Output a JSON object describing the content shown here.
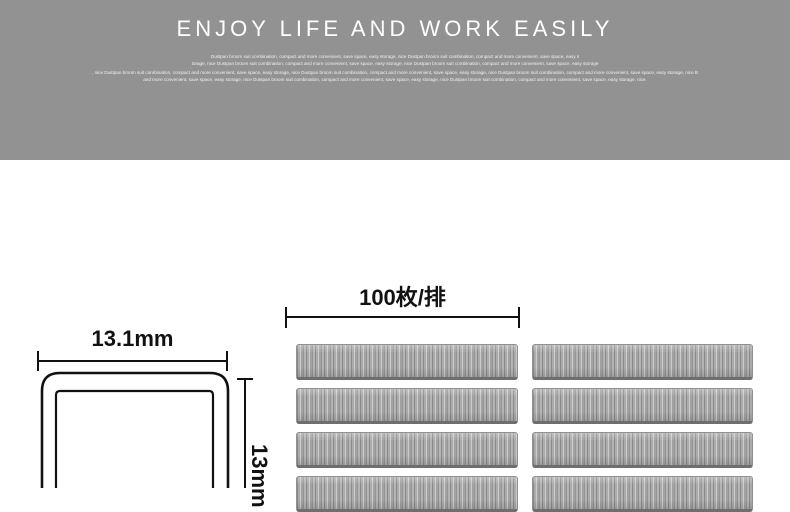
{
  "banner": {
    "background_color": "#929292",
    "text_color": "#ffffff",
    "title": "ENJOY LIFE AND WORK EASILY",
    "paragraph1_line1": "Dustpan broom suit combination, compact and more convenient, save space, easy storage, nice Dustpan broom suit combination, compact and more convenient, save space, easy s",
    "paragraph1_line2": "torage, nice Dustpan broom suit combination, compact and more convenient, save space, easy storage, nice Dustpan broom suit combination, compact and more convenient, save space, easy storage",
    "paragraph2_line1": ", nice Dustpan broom suit combination, compact and more convenient, save space, easy storage, nice Dustpan broom suit combination, compact and more convenient, save space, easy storage, nice Dustpan broom suit combination, compact and more convenient, save space, easy storage, nice B",
    "paragraph2_line2": "and more convenient, save space, easy storage, nice Dustpan broom suit combination, compact and more convenient, save space, easy storage, nice Dustpan broom suit combination, compact and more convenient, save space, easy storage, nice."
  },
  "diagram": {
    "line_color": "#111111",
    "staple_cross_section": {
      "width_label": "13.1mm",
      "height_label": "13mm"
    },
    "staple_strips": {
      "count_label": "100枚/排",
      "columns": 2,
      "rows": 4
    }
  }
}
